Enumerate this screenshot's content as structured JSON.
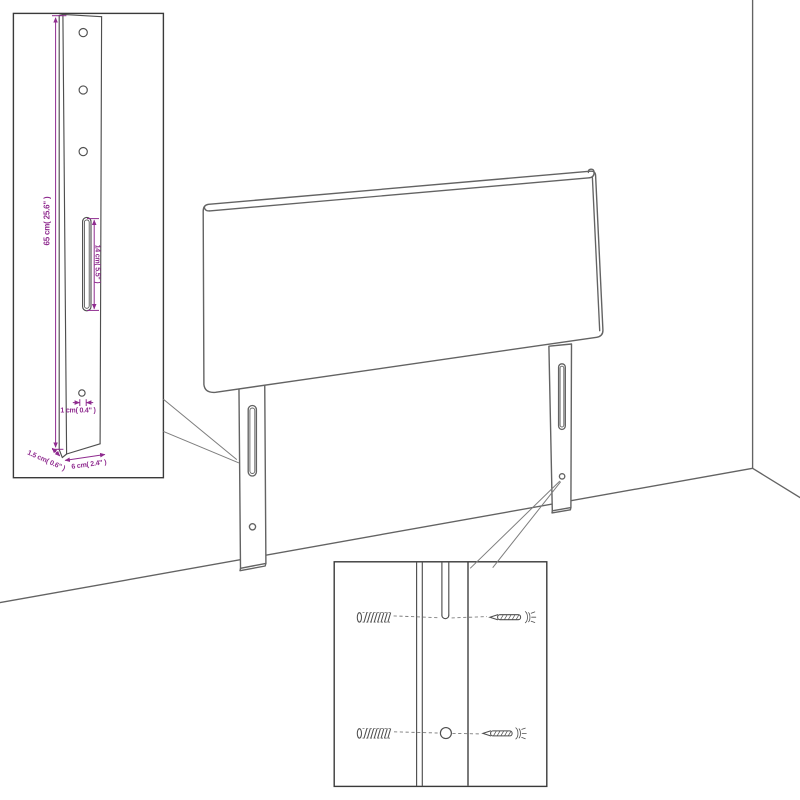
{
  "theme": {
    "background": "#ffffff",
    "line": "#636363",
    "detail-line": "#4f4f4f",
    "inset-border": "#3a3a3a",
    "callout": "#7d7d7d",
    "accent": "#8f2b8f"
  },
  "bracket_inset": {
    "dimensions": {
      "height": "65 cm( 25.6\" )",
      "slot_length": "14 cm( 5.5\" )",
      "hole_diameter": "1 cm( 0.4\" )",
      "thickness": "1.5 cm( 0.6\" )",
      "width": "6 cm( 2.4\" )"
    }
  },
  "mounting_inset": {
    "hardware": [
      "wall-anchor",
      "screw",
      "wall-anchor",
      "screw"
    ]
  }
}
